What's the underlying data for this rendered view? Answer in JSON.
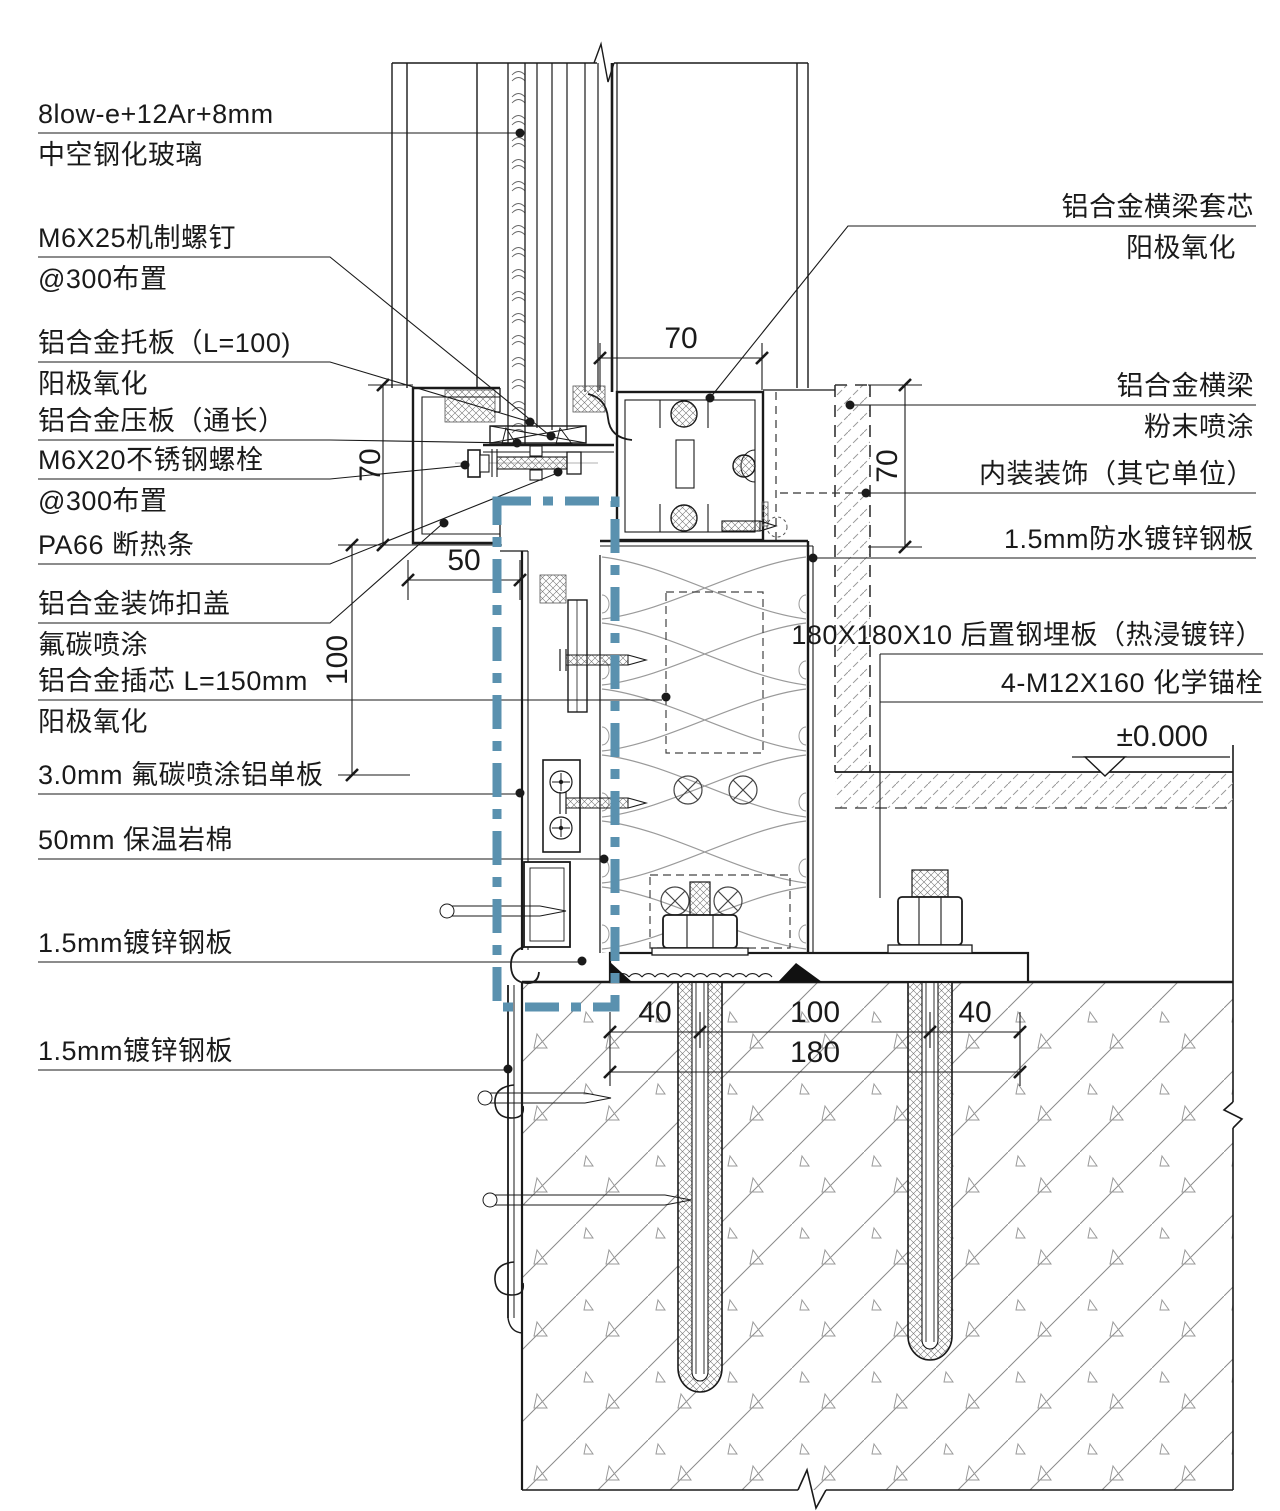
{
  "labels_left": [
    {
      "id": "insulated-glass",
      "line1": "8low-e+12Ar+8mm",
      "line2": "中空钢化玻璃"
    },
    {
      "id": "machine-screw",
      "line1": "M6X25机制螺钉",
      "line2": "@300布置"
    },
    {
      "id": "support-plate",
      "line1": "铝合金托板（L=100)",
      "line2": "阳极氧化"
    },
    {
      "id": "pressure-plate",
      "line1": "铝合金压板（通长）",
      "line2": ""
    },
    {
      "id": "ss-bolt",
      "line1": "M6X20不锈钢螺栓",
      "line2": "@300布置"
    },
    {
      "id": "thermal-break",
      "line1": "PA66 断热条",
      "line2": ""
    },
    {
      "id": "cover-cap",
      "line1": "铝合金装饰扣盖",
      "line2": "氟碳喷涂"
    },
    {
      "id": "core-insert",
      "line1": "铝合金插芯  L=150mm",
      "line2": "阳极氧化"
    },
    {
      "id": "alu-panel",
      "line1": "3.0mm 氟碳喷涂铝单板",
      "line2": ""
    },
    {
      "id": "rockwool",
      "line1": "50mm 保温岩棉",
      "line2": ""
    },
    {
      "id": "galv-sheet-1",
      "line1": "1.5mm镀锌钢板",
      "line2": ""
    },
    {
      "id": "galv-sheet-2",
      "line1": "1.5mm镀锌钢板",
      "line2": ""
    }
  ],
  "labels_right": [
    {
      "id": "transom-core",
      "line1": "铝合金横梁套芯",
      "line2": "阳极氧化"
    },
    {
      "id": "transom",
      "line1": "铝合金横梁",
      "line2": "粉末喷涂"
    },
    {
      "id": "interior-finish",
      "line1": "内装装饰（其它单位）",
      "line2": ""
    },
    {
      "id": "waterproof-sheet",
      "line1": "1.5mm防水镀锌钢板",
      "line2": ""
    },
    {
      "id": "embed-plate",
      "line1": "180X180X10 后置钢埋板（热浸镀锌）",
      "line2": ""
    },
    {
      "id": "chem-anchor",
      "line1": "4-M12X160  化学锚栓",
      "line2": ""
    }
  ],
  "dimensions": {
    "transom_width": "70",
    "transom_height_left": "70",
    "transom_height_right": "70",
    "cover_width": "50",
    "panel_offset": "100",
    "edge_left": "40",
    "anchor_spacing": "100",
    "edge_right": "40",
    "plate_width": "180"
  },
  "level_mark": {
    "value": "±0.000"
  },
  "colors": {
    "line": "#1a1a1a",
    "hatch": "#8a8a8a",
    "highlight_box": "#5a91af"
  }
}
